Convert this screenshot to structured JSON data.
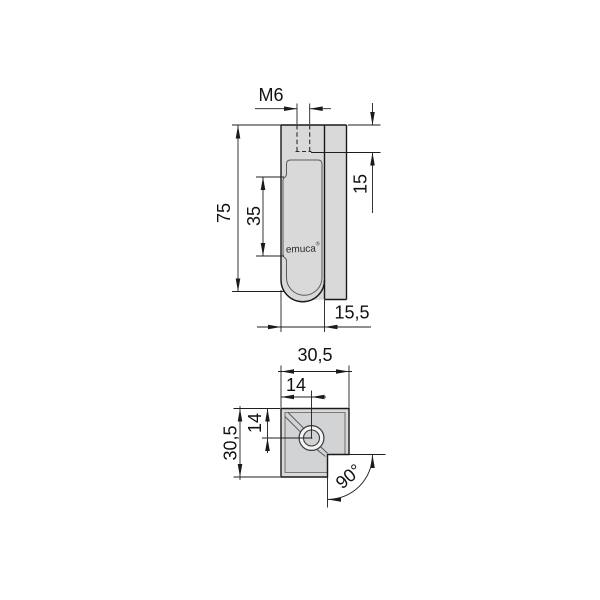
{
  "side_view": {
    "thread_label": "M6",
    "total_height": "75",
    "slot_length": "35",
    "thread_depth": "15",
    "hook_width": "15,5",
    "brand": "emuca",
    "brand_mark": "®"
  },
  "section_view": {
    "overall_width": "30,5",
    "hole_offset_x": "14",
    "hole_offset_y": "14",
    "overall_depth": "30,5",
    "corner_angle": "90°"
  },
  "colors": {
    "body_fill": "#d9d9d9",
    "inner_fill": "#d1d3d4",
    "hub_ring_fill": "#f5f5f5",
    "background": "#ffffff"
  }
}
